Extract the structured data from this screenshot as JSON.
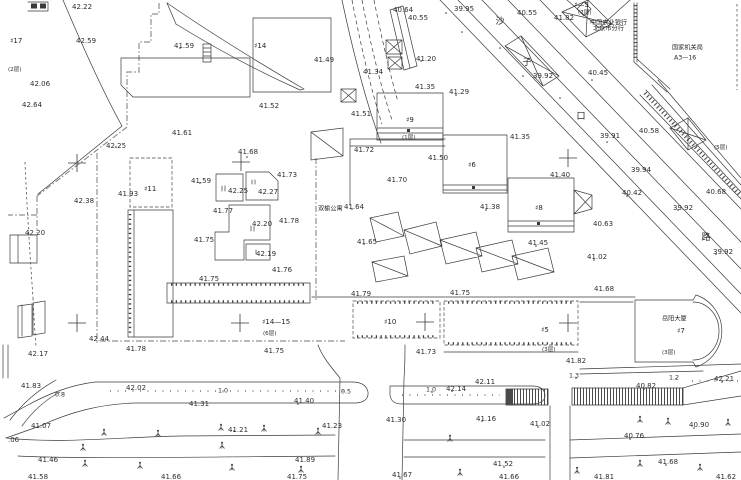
{
  "colors": {
    "paper": "#ffffff",
    "ink": "#3a3a3a",
    "fence_gray": "#8f8f8f"
  },
  "map": {
    "type": "topographic-survey-site-plan",
    "labels": [
      {
        "t": "42.22",
        "x": 72,
        "y": 7
      },
      {
        "t": "42.59",
        "x": 76,
        "y": 41
      },
      {
        "t": "42.06",
        "x": 30,
        "y": 84
      },
      {
        "t": "42.64",
        "x": 22,
        "y": 105
      },
      {
        "t": "41.59",
        "x": 174,
        "y": 46
      },
      {
        "t": "41.61",
        "x": 172,
        "y": 133
      },
      {
        "t": "42.25",
        "x": 106,
        "y": 146
      },
      {
        "t": "41.93",
        "x": 118,
        "y": 194
      },
      {
        "t": "42.38",
        "x": 74,
        "y": 201
      },
      {
        "t": "42.20",
        "x": 25,
        "y": 233
      },
      {
        "t": "42.44",
        "x": 89,
        "y": 339
      },
      {
        "t": "42.17",
        "x": 28,
        "y": 354
      },
      {
        "t": "41.83",
        "x": 21,
        "y": 386
      },
      {
        "t": "42.02",
        "x": 126,
        "y": 388
      },
      {
        "t": "41.07",
        "x": 31,
        "y": 426
      },
      {
        "t": "41.46",
        "x": 38,
        "y": 460
      },
      {
        "t": "41.58",
        "x": 28,
        "y": 477
      },
      {
        "t": ".06",
        "x": 8,
        "y": 440
      },
      {
        "t": "41.78",
        "x": 126,
        "y": 349
      },
      {
        "t": "41.49",
        "x": 314,
        "y": 60
      },
      {
        "t": "41.52",
        "x": 259,
        "y": 106
      },
      {
        "t": "41.51",
        "x": 351,
        "y": 114
      },
      {
        "t": "41.34",
        "x": 363,
        "y": 72
      },
      {
        "t": "40.64",
        "x": 393,
        "y": 10
      },
      {
        "t": "40.55",
        "x": 408,
        "y": 18
      },
      {
        "t": "39.95",
        "x": 454,
        "y": 9
      },
      {
        "t": "40.55",
        "x": 517,
        "y": 13
      },
      {
        "t": "41.82",
        "x": 554,
        "y": 18
      },
      {
        "t": "41.20",
        "x": 416,
        "y": 59
      },
      {
        "t": "41.35",
        "x": 415,
        "y": 87
      },
      {
        "t": "41.29",
        "x": 449,
        "y": 92
      },
      {
        "t": "41.72",
        "x": 354,
        "y": 150
      },
      {
        "t": "41.50",
        "x": 428,
        "y": 158
      },
      {
        "t": "41.70",
        "x": 387,
        "y": 180
      },
      {
        "t": "41.64",
        "x": 344,
        "y": 207
      },
      {
        "t": "41.65",
        "x": 357,
        "y": 242
      },
      {
        "t": "40.45",
        "x": 588,
        "y": 73
      },
      {
        "t": "39.92",
        "x": 533,
        "y": 76
      },
      {
        "t": "40.58",
        "x": 639,
        "y": 131
      },
      {
        "t": "39.91",
        "x": 600,
        "y": 136
      },
      {
        "t": "41.35",
        "x": 510,
        "y": 137
      },
      {
        "t": "41.40",
        "x": 550,
        "y": 175
      },
      {
        "t": "40.42",
        "x": 622,
        "y": 193
      },
      {
        "t": "39.94",
        "x": 631,
        "y": 170
      },
      {
        "t": "39.92",
        "x": 673,
        "y": 208
      },
      {
        "t": "40.68",
        "x": 706,
        "y": 192
      },
      {
        "t": "40.63",
        "x": 593,
        "y": 224
      },
      {
        "t": "39.92",
        "x": 713,
        "y": 252
      },
      {
        "t": "41.38",
        "x": 480,
        "y": 207
      },
      {
        "t": "41.45",
        "x": 528,
        "y": 243
      },
      {
        "t": "41.02",
        "x": 587,
        "y": 257
      },
      {
        "t": "41.68",
        "x": 594,
        "y": 289
      },
      {
        "t": "41.73",
        "x": 277,
        "y": 175
      },
      {
        "t": "42.25",
        "x": 228,
        "y": 191
      },
      {
        "t": "42.27",
        "x": 258,
        "y": 192
      },
      {
        "t": "41.77",
        "x": 213,
        "y": 211
      },
      {
        "t": "42.20",
        "x": 252,
        "y": 224
      },
      {
        "t": "41.78",
        "x": 279,
        "y": 221
      },
      {
        "t": "41.75",
        "x": 194,
        "y": 240
      },
      {
        "t": "42.19",
        "x": 256,
        "y": 254
      },
      {
        "t": "41.76",
        "x": 272,
        "y": 270
      },
      {
        "t": "41.75",
        "x": 199,
        "y": 279
      },
      {
        "t": "41.68",
        "x": 238,
        "y": 152
      },
      {
        "t": "41.59",
        "x": 191,
        "y": 181
      },
      {
        "t": "41.75",
        "x": 264,
        "y": 351
      },
      {
        "t": "41.79",
        "x": 351,
        "y": 294
      },
      {
        "t": "41.75",
        "x": 450,
        "y": 293
      },
      {
        "t": "41.73",
        "x": 416,
        "y": 352
      },
      {
        "t": "41.82",
        "x": 566,
        "y": 361
      },
      {
        "t": "40.82",
        "x": 636,
        "y": 386
      },
      {
        "t": "42.21",
        "x": 714,
        "y": 379
      },
      {
        "t": "42.11",
        "x": 475,
        "y": 382
      },
      {
        "t": "42.14",
        "x": 446,
        "y": 389
      },
      {
        "t": "41.31",
        "x": 189,
        "y": 404
      },
      {
        "t": "41.40",
        "x": 294,
        "y": 401
      },
      {
        "t": "41.30",
        "x": 386,
        "y": 420
      },
      {
        "t": "41.21",
        "x": 228,
        "y": 430
      },
      {
        "t": "41.23",
        "x": 322,
        "y": 426
      },
      {
        "t": "41.89",
        "x": 295,
        "y": 460
      },
      {
        "t": "41.75",
        "x": 287,
        "y": 477
      },
      {
        "t": "41.66",
        "x": 161,
        "y": 477
      },
      {
        "t": "41.67",
        "x": 392,
        "y": 475
      },
      {
        "t": "41.16",
        "x": 476,
        "y": 419
      },
      {
        "t": "41.02",
        "x": 530,
        "y": 424
      },
      {
        "t": "40.90",
        "x": 689,
        "y": 425
      },
      {
        "t": "40.76",
        "x": 624,
        "y": 436
      },
      {
        "t": "41.52",
        "x": 493,
        "y": 464
      },
      {
        "t": "41.66",
        "x": 499,
        "y": 477
      },
      {
        "t": "41.68",
        "x": 658,
        "y": 462
      },
      {
        "t": "41.81",
        "x": 594,
        "y": 477
      },
      {
        "t": "41.62",
        "x": 716,
        "y": 477
      },
      {
        "t": "♯17",
        "x": 10,
        "y": 41,
        "k": "bldg"
      },
      {
        "t": "♯14",
        "x": 254,
        "y": 46,
        "k": "bldg"
      },
      {
        "t": "♯11",
        "x": 144,
        "y": 189,
        "k": "bldg"
      },
      {
        "t": "♯9",
        "x": 406,
        "y": 120,
        "k": "bldg"
      },
      {
        "t": "♯6",
        "x": 468,
        "y": 165,
        "k": "bldg"
      },
      {
        "t": "♯8",
        "x": 535,
        "y": 208,
        "k": "bldg"
      },
      {
        "t": "♯14—15",
        "x": 262,
        "y": 322,
        "k": "bldg"
      },
      {
        "t": "♯10",
        "x": 384,
        "y": 322,
        "k": "bldg"
      },
      {
        "t": "♯5",
        "x": 541,
        "y": 330,
        "k": "bldg"
      },
      {
        "t": "♯7",
        "x": 677,
        "y": 331,
        "k": "bldg"
      },
      {
        "t": "♯—5",
        "x": 574,
        "y": 5,
        "k": "bldg"
      },
      {
        "t": "(2层)",
        "x": 8,
        "y": 70,
        "k": "floor"
      },
      {
        "t": "(7层)",
        "x": 578,
        "y": 13,
        "k": "floor"
      },
      {
        "t": "(1层)",
        "x": 402,
        "y": 138,
        "k": "floor"
      },
      {
        "t": "(6层)",
        "x": 263,
        "y": 334,
        "k": "floor"
      },
      {
        "t": "(3层)",
        "x": 542,
        "y": 350,
        "k": "floor"
      },
      {
        "t": "(3层)",
        "x": 662,
        "y": 353,
        "k": "floor"
      },
      {
        "t": "(5层)",
        "x": 714,
        "y": 148,
        "k": "floor"
      },
      {
        "t": "双榆公寓",
        "x": 318,
        "y": 209,
        "k": "name"
      },
      {
        "t": "岳阳大厦",
        "x": 662,
        "y": 319,
        "k": "name"
      },
      {
        "t": "中国农业银行",
        "x": 590,
        "y": 23,
        "k": "name",
        "s": 4.6
      },
      {
        "t": "北京市分行",
        "x": 593,
        "y": 29,
        "k": "name",
        "s": 4.6
      },
      {
        "t": "国家机关局",
        "x": 672,
        "y": 48,
        "k": "name"
      },
      {
        "t": "A3—16",
        "x": 674,
        "y": 58,
        "k": "name"
      },
      {
        "t": "1.0",
        "x": 218,
        "y": 391,
        "k": "width"
      },
      {
        "t": "0.8",
        "x": 55,
        "y": 395,
        "k": "width"
      },
      {
        "t": "0.5",
        "x": 341,
        "y": 392,
        "k": "width"
      },
      {
        "t": "1.0",
        "x": 426,
        "y": 390,
        "k": "width"
      },
      {
        "t": "1.3",
        "x": 569,
        "y": 376,
        "k": "width"
      },
      {
        "t": "1.2",
        "x": 669,
        "y": 378,
        "k": "width"
      },
      {
        "t": "沙",
        "x": 500,
        "y": 22,
        "k": "street"
      },
      {
        "t": "子",
        "x": 527,
        "y": 63,
        "k": "street"
      },
      {
        "t": "口",
        "x": 581,
        "y": 117,
        "k": "street"
      },
      {
        "t": "路",
        "x": 706,
        "y": 238,
        "k": "street"
      }
    ]
  }
}
